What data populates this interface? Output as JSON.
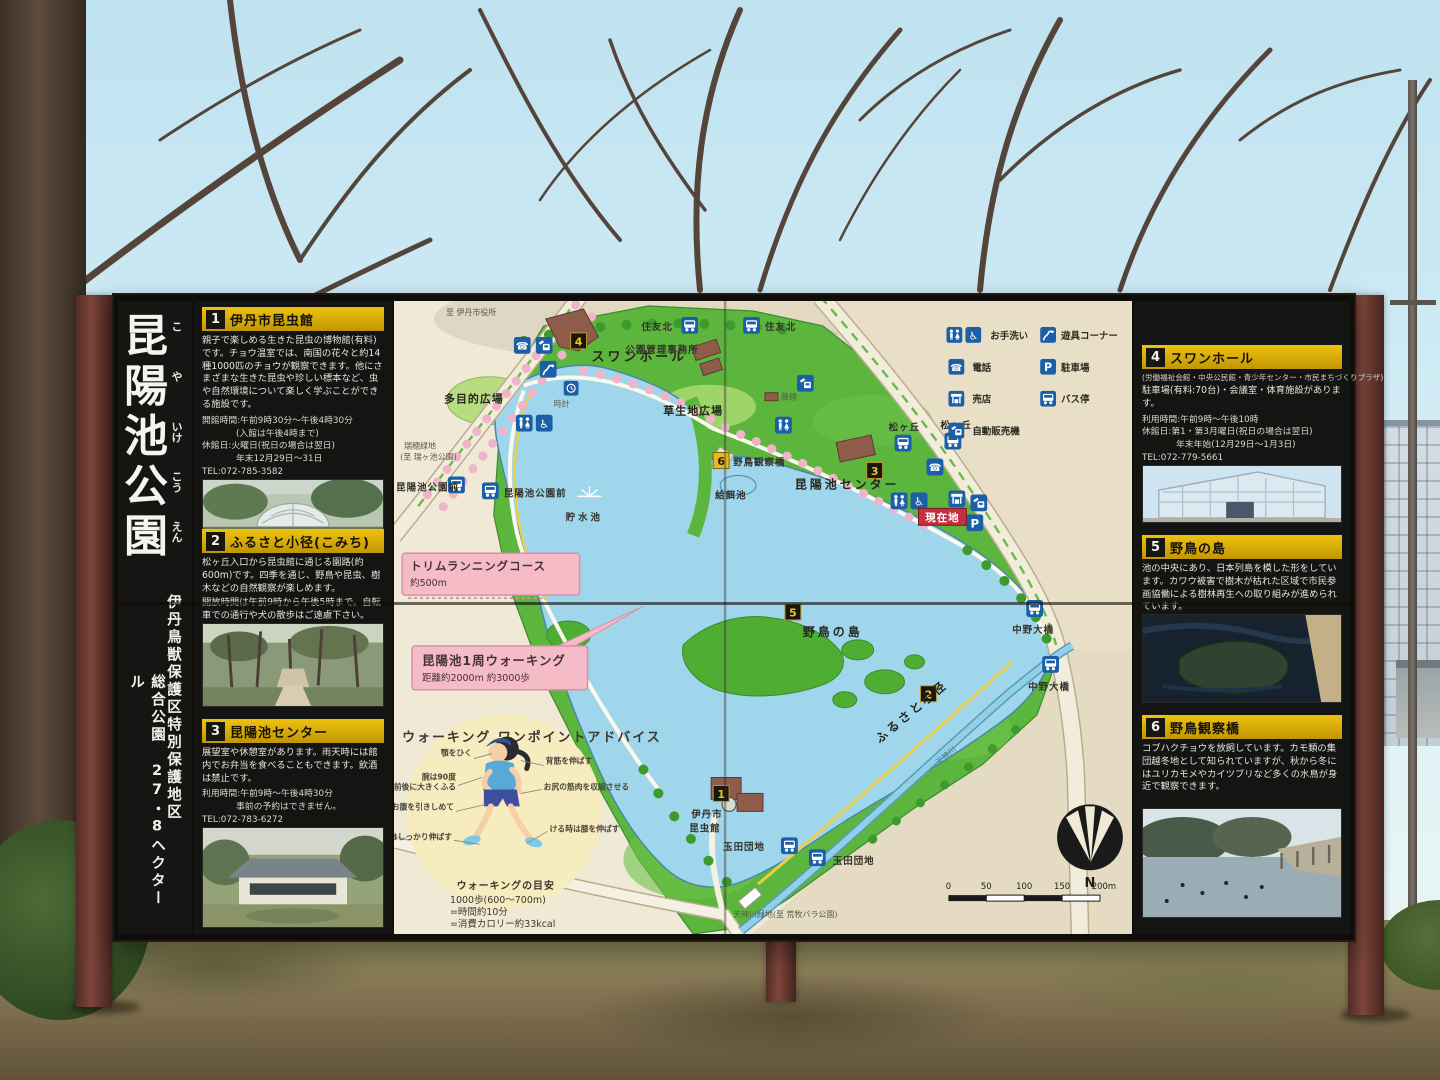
{
  "colors": {
    "panel_header": "#d4a908",
    "badge_red": "#c43040",
    "icon_blue": "#1b5fa8",
    "water": "#9fd6ec",
    "park_green": "#5cb63e",
    "callout_pink": "#f5bcc8",
    "post_brown": "#6e3c32",
    "board_black": "#141413",
    "map_cream": "#efe9d6"
  },
  "sign": {
    "title_chars": [
      {
        "c": "昆",
        "k": "こ"
      },
      {
        "c": "陽",
        "k": "や"
      },
      {
        "c": "池",
        "k": "いけ"
      },
      {
        "c": "公",
        "k": "こう"
      },
      {
        "c": "園",
        "k": "えん"
      }
    ],
    "subtitle_right": "伊丹鳥獣保護区特別保護地区",
    "subtitle_left": "総合公園 27・8ヘクタール"
  },
  "panels": [
    {
      "num": "1",
      "title": "伊丹市昆虫館",
      "body": "親子で楽しめる生きた昆虫の博物館(有料)です。チョウ温室では、南国の花々と約14種1000匹のチョウが観察できます。他にさまざまな生きた昆虫や珍しい標本など、虫や自然環境について楽しく学ぶことができる施設です。",
      "info": [
        "開館時間:午前9時30分〜午後4時30分",
        "(入館は午後4時まで)",
        "休館日:火曜日(祝日の場合は翌日)",
        "年末12月29日〜31日",
        "TEL:072-785-3582"
      ]
    },
    {
      "num": "2",
      "title": "ふるさと小径(こみち)",
      "body": "松ヶ丘入口から昆虫館に通じる園路(約600m)です。四季を通じ、野鳥や昆虫、樹木などの自然観察が楽しめます。",
      "body2": "開放時間は午前9時から午後5時まで。自転車での通行や犬の散歩はご遠慮下さい。"
    },
    {
      "num": "3",
      "title": "昆陽池センター",
      "body": "展望室や休憩室があります。雨天時には館内でお弁当を食べることもできます。飲酒は禁止です。",
      "info": [
        "利用時間:午前9時〜午後4時30分",
        "事前の予約はできません。",
        "TEL:072-783-6272"
      ]
    },
    {
      "num": "4",
      "title": "スワンホール",
      "note": "(労働福祉会館・中央公民館・青少年センター・市民まちづくりプラザ)",
      "body": "駐車場(有料:70台)・会議室・体育施設があります。",
      "info": [
        "利用時間:午前9時〜午後10時",
        "休館日:第1・第3月曜日(祝日の場合は翌日)",
        "年末年始(12月29日〜1月3日)",
        "TEL:072-779-5661"
      ]
    },
    {
      "num": "5",
      "title": "野鳥の島",
      "body": "池の中央にあり、日本列島を模した形をしています。カワウ被害で樹木が枯れた区域で市民参画協働による樹林再生への取り組みが進められています。"
    },
    {
      "num": "6",
      "title": "野鳥観察橋",
      "body": "コブハクチョウを放飼しています。カモ類の集団越冬地として知られていますが、秋から冬にはユリカモメやカイツブリなど多くの水鳥が身近で観察できます。"
    }
  ],
  "map": {
    "to_city_hall": "至 伊丹市役所",
    "sumitomo_kita": "住友北",
    "swan_hall_label": "スワンホール",
    "park_office": "公園管理事務所",
    "multipurpose_plaza": "多目的広場",
    "clock": "時計",
    "grass_plaza": "草生地広場",
    "fujidana": "藤棚",
    "bird_bridge": "野鳥観察橋",
    "feeding_pond": "給餌池",
    "konyoike_center": "昆陽池センター",
    "matsugaoka": "松ヶ丘",
    "current_location": "現在地",
    "reservoir": "貯水池",
    "mizuho_l1": "瑞穂緑地",
    "mizuho_l2": "(至 瑞ヶ池公園)",
    "koenmae": "昆陽池公園前",
    "bird_island": "野鳥の島",
    "nakano_ohashi": "中野大橋",
    "furusato_komichi": "ふるさと小径",
    "tenjingawa": "天神川",
    "insect_l1": "伊丹市",
    "insect_l2": "昆虫館",
    "tamada": "玉田団地",
    "tenjin_ryokuchi": "天神川緑地(至 荒牧バラ公園)",
    "badges": {
      "b1": "1",
      "b2": "2",
      "b3": "3",
      "b4": "4",
      "b5": "5",
      "b6": "6"
    },
    "callout_trim": {
      "title": "トリムランニングコース",
      "sub": "約500m"
    },
    "callout_walk": {
      "title": "昆陽池1周ウォーキング",
      "sub": "距離約2000m 約3000歩"
    },
    "legend": {
      "toilet": "お手洗い",
      "phone": "電話",
      "shop": "売店",
      "vending": "自動販売機",
      "playground": "遊具コーナー",
      "parking": "駐車場",
      "bus": "バス停"
    },
    "walking": {
      "title": "ウォーキング ワンポイントアドバイス",
      "ago": "顎をひく",
      "ude1": "腕は90度",
      "ude2": "前後に大きくふる",
      "onaka": "お腹を引きしめて",
      "ashi": "足はしっかり伸ばす",
      "sesuji": "背筋を伸ばす",
      "oshiri": "お尻の筋肉を収縮させる",
      "keru": "ける時は膝を伸ばす",
      "guide_title": "ウォーキングの目安",
      "g1": "1000歩(600〜700m)",
      "g2": "=時間約10分",
      "g3": "=消費カロリー約33kcal"
    },
    "scale": {
      "t0": "0",
      "t1": "50",
      "t2": "100",
      "t3": "150",
      "t4": "200m"
    },
    "north": "N"
  }
}
